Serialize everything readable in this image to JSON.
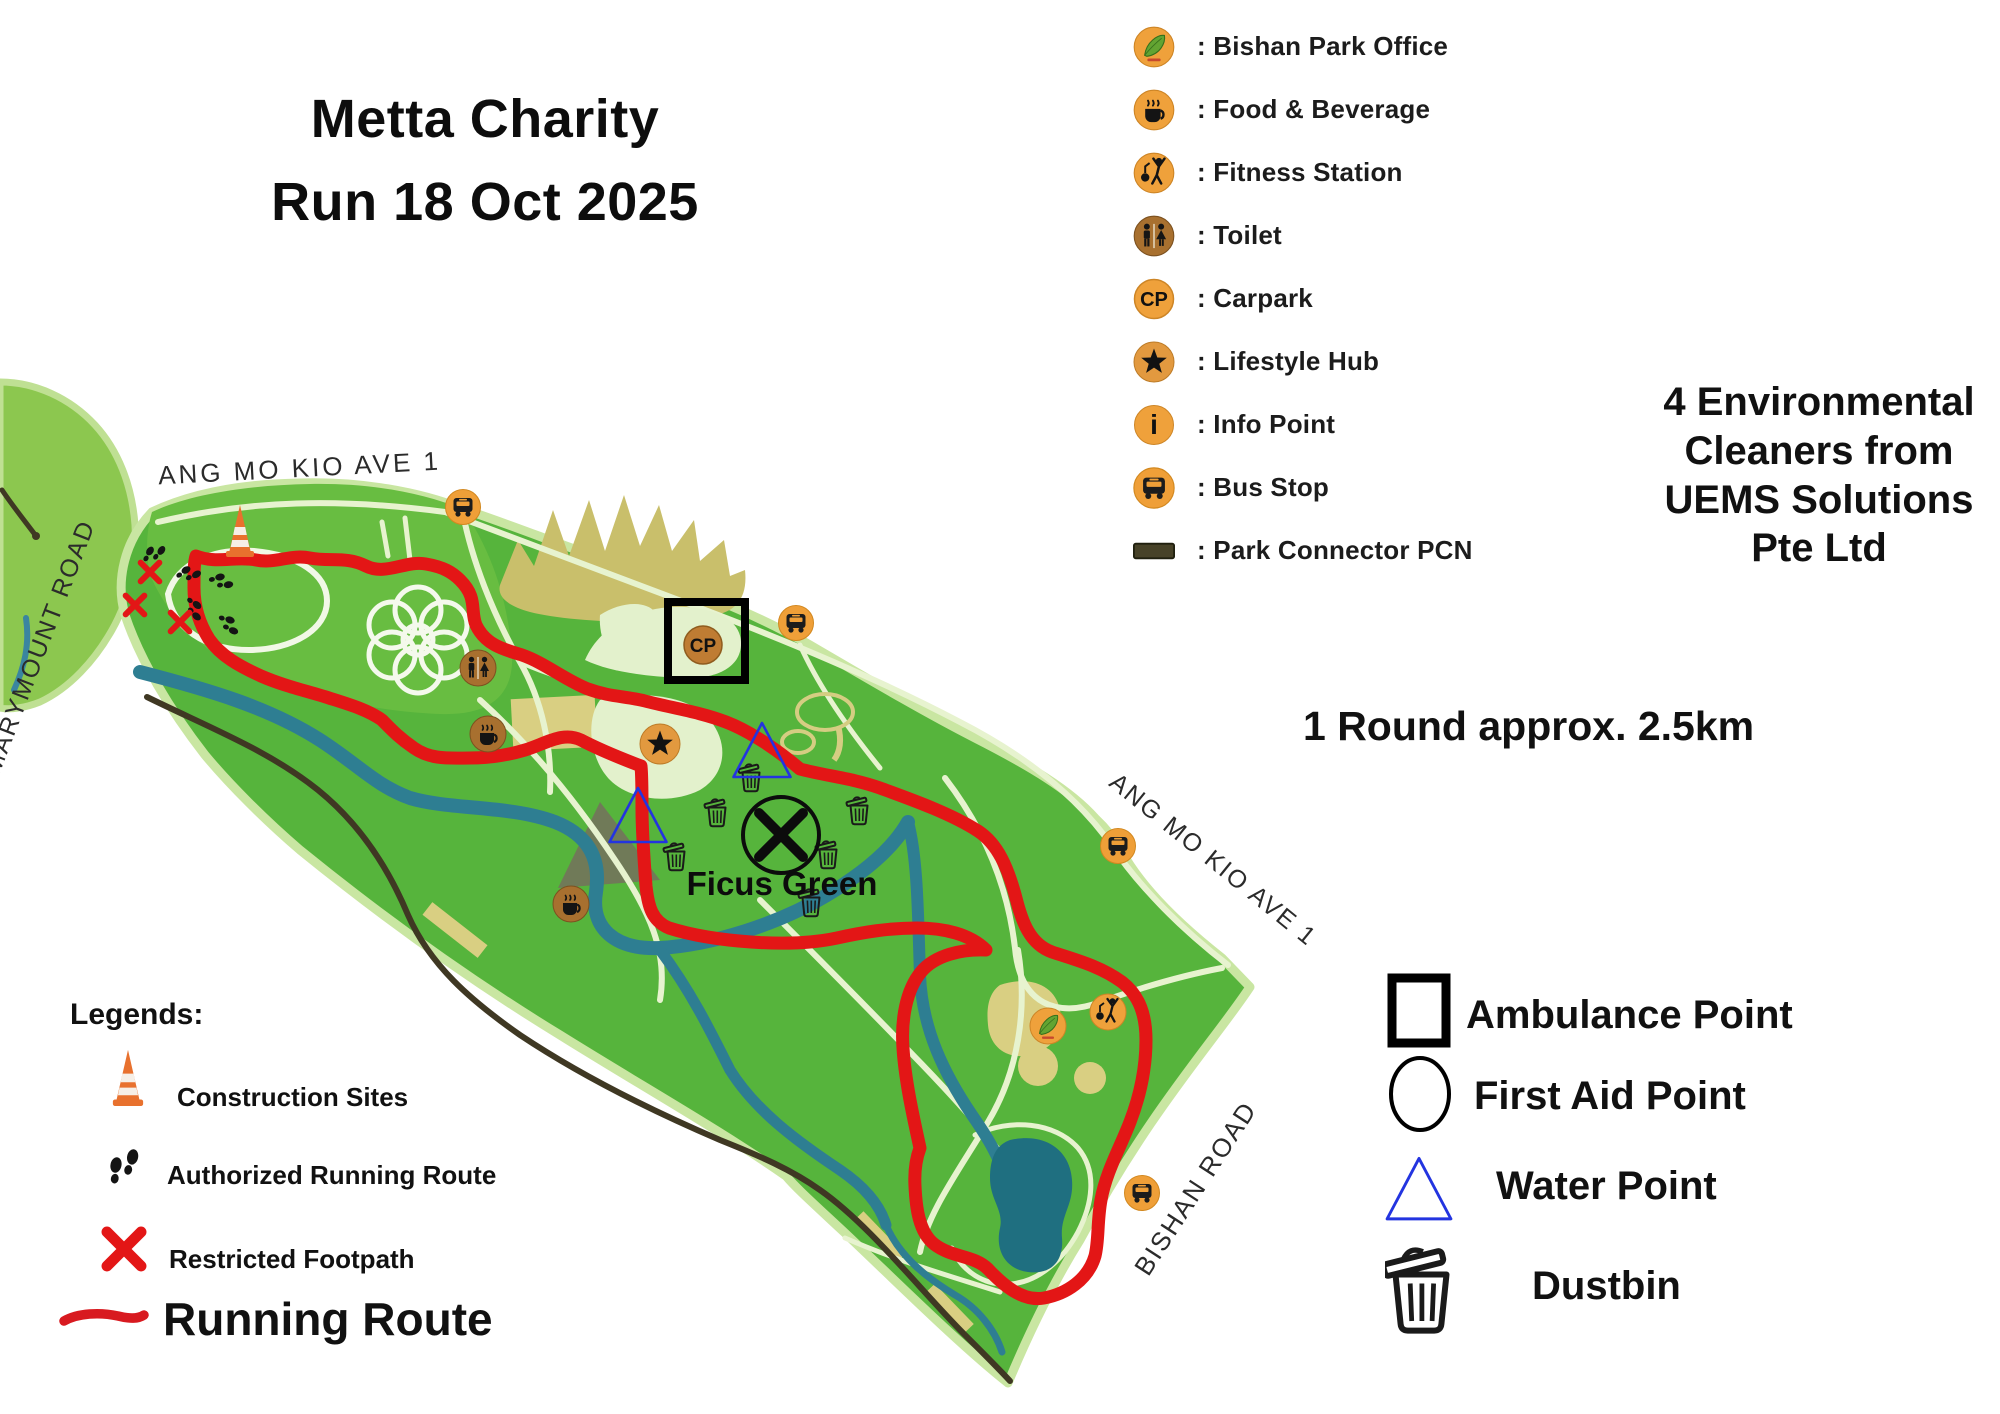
{
  "title": {
    "line1": "Metta Charity",
    "line2": "Run 18 Oct 2025"
  },
  "facilities_legend": {
    "carpark_abbr": "CP",
    "info_abbr": "i",
    "items": [
      {
        "icon": "park-office-icon",
        "label": ": Bishan Park Office"
      },
      {
        "icon": "food-beverage-icon",
        "label": ": Food & Beverage"
      },
      {
        "icon": "fitness-icon",
        "label": ": Fitness Station"
      },
      {
        "icon": "toilet-icon",
        "label": ": Toilet"
      },
      {
        "icon": "carpark-icon",
        "label": ": Carpark"
      },
      {
        "icon": "lifestyle-hub-icon",
        "label": ": Lifestyle Hub"
      },
      {
        "icon": "info-point-icon",
        "label": ": Info Point"
      },
      {
        "icon": "bus-stop-icon",
        "label": ": Bus Stop"
      },
      {
        "icon": "park-connector-icon",
        "label": ": Park Connector PCN"
      }
    ]
  },
  "annotations": {
    "cleaners_lines": [
      "4 Environmental",
      "Cleaners from",
      "UEMS Solutions",
      "Pte Ltd"
    ],
    "round_distance": "1 Round approx. 2.5km"
  },
  "map": {
    "labels": {
      "road_top": "ANG MO KIO AVE 1",
      "road_left": "MARYMOUNT ROAD",
      "road_right": "ANG MO KIO AVE 1",
      "road_bottom": "BISHAN ROAD",
      "area": "Ficus Green"
    }
  },
  "site_legend": {
    "heading": "Legends:",
    "items": [
      {
        "icon": "construction-cone-icon",
        "label": "Construction Sites"
      },
      {
        "icon": "footprints-icon",
        "label": "Authorized Running Route"
      },
      {
        "icon": "restricted-cross-icon",
        "label": "Restricted Footpath"
      },
      {
        "icon": "route-line-icon",
        "label": "Running Route"
      }
    ]
  },
  "points_legend": {
    "items": [
      {
        "icon": "square-icon",
        "label": "Ambulance Point"
      },
      {
        "icon": "circle-icon",
        "label": "First Aid Point"
      },
      {
        "icon": "triangle-icon",
        "label": "Water Point"
      },
      {
        "icon": "dustbin-icon",
        "label": "Dustbin"
      }
    ]
  },
  "colors": {
    "route_red": "#e31616",
    "park_green": "#56b43c",
    "park_light_green": "#8cc74f",
    "river_teal": "#2e7e92",
    "pond_teal": "#1f6f80",
    "icon_orange": "#efa13b",
    "water_point_blue": "#2334e0",
    "pcn_dark": "#3f3823"
  }
}
